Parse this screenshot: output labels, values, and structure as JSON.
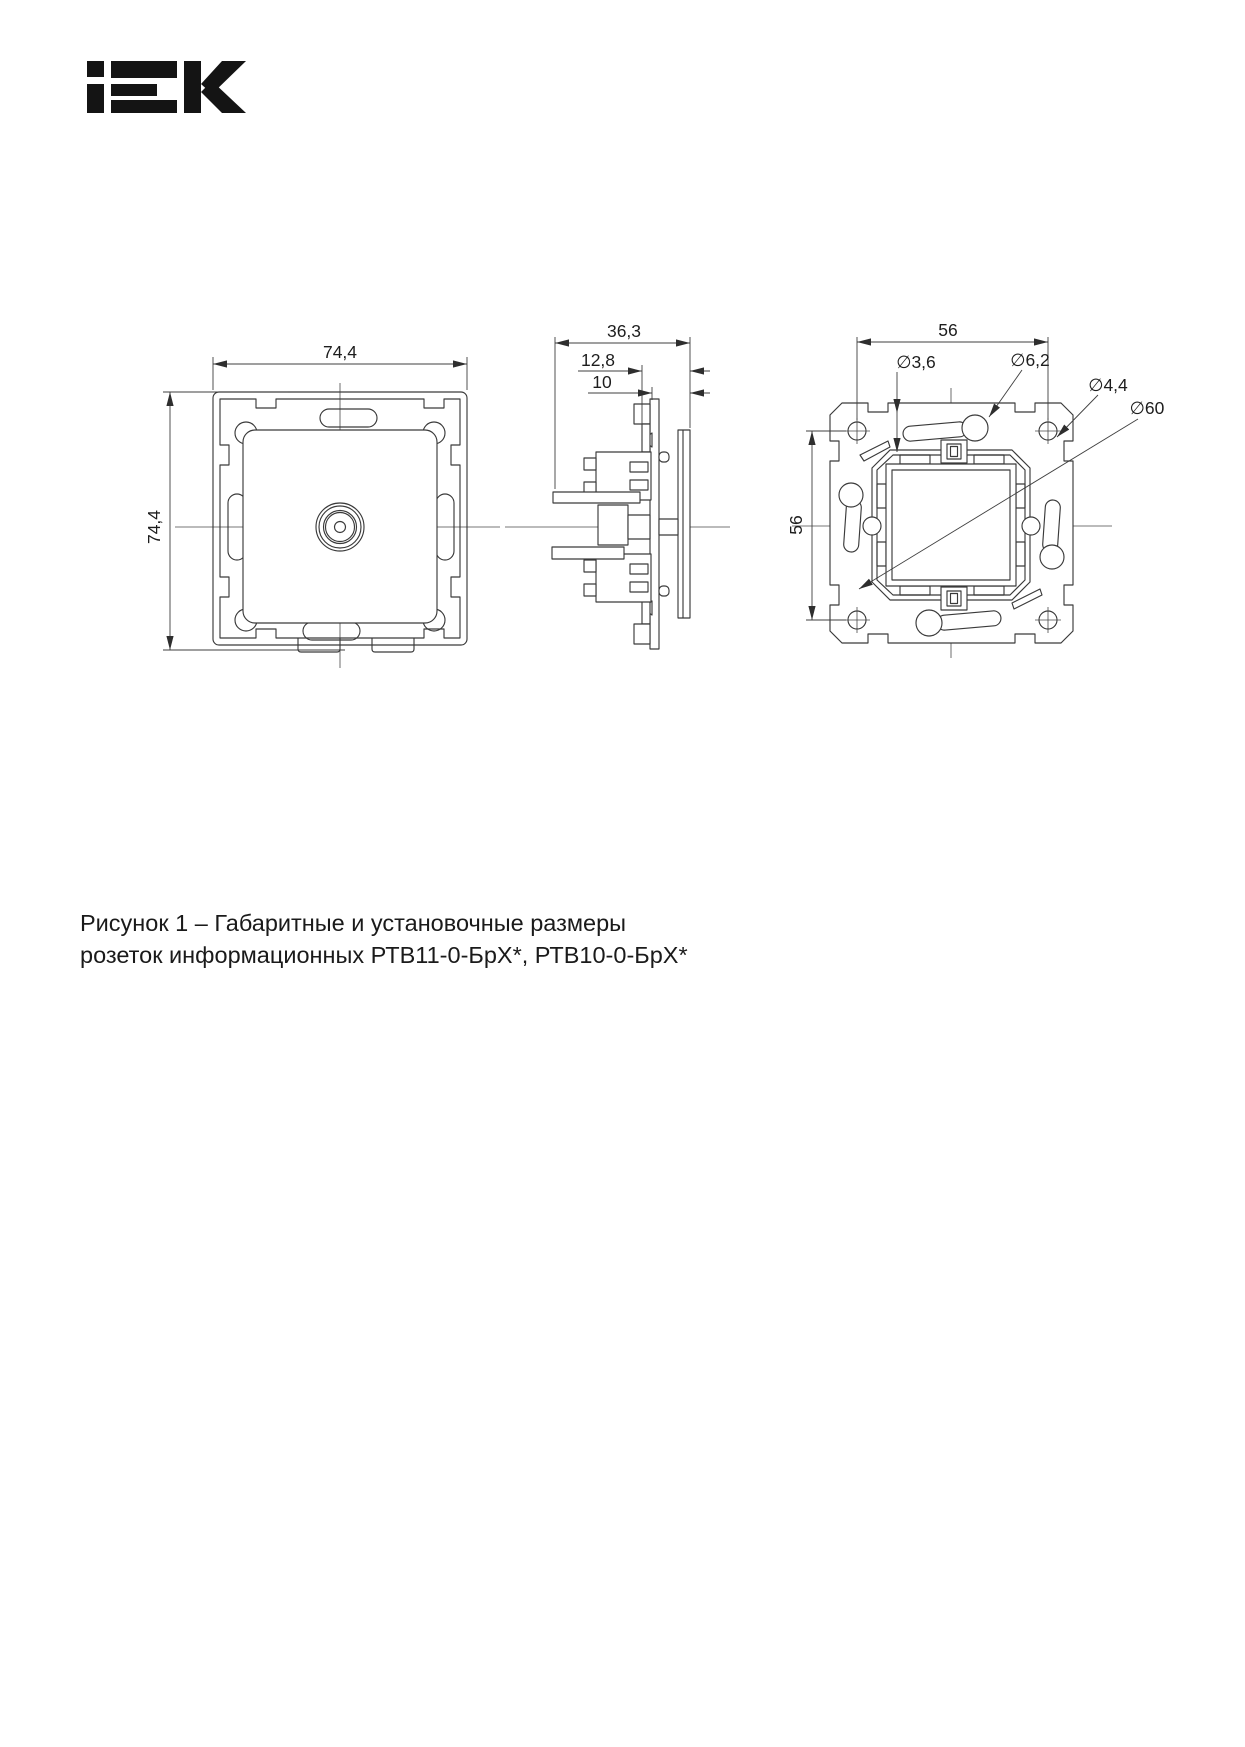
{
  "logo": {
    "alt": "IEK"
  },
  "figure": {
    "front_view": {
      "width": "74,4",
      "height": "74,4"
    },
    "side_view": {
      "depth_total": "36,3",
      "depth_cover": "12,8",
      "depth_frame": "10"
    },
    "rear_view": {
      "width": "56",
      "height": "56",
      "dia_claw_hole": "∅3,6",
      "dia_slot": "∅6,2",
      "dia_screw_hole": "∅4,4",
      "dia_box": "∅60"
    }
  },
  "caption": {
    "line1": "Рисунок 1 – Габаритные и установочные размеры",
    "line2": "розеток информационных РТВ11-0-БрХ*, РТВ10-0-БрХ*"
  }
}
